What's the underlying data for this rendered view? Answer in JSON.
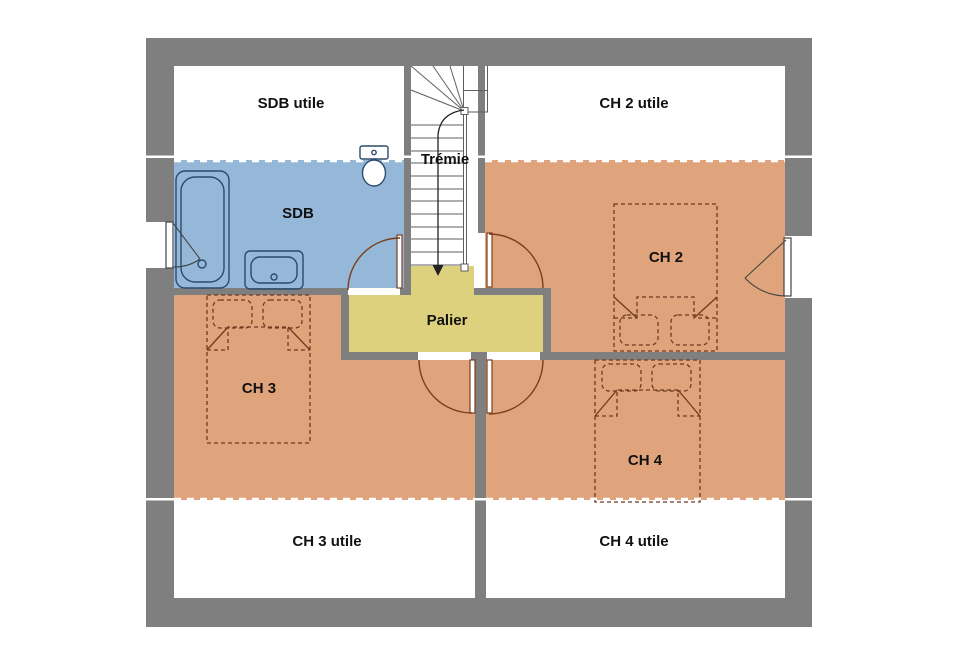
{
  "plan": {
    "labels": {
      "sdb_utile": "SDB utile",
      "ch2_utile": "CH 2 utile",
      "tremie": "Trémie",
      "sdb": "SDB",
      "palier": "Palier",
      "ch2": "CH 2",
      "ch3": "CH 3",
      "ch4": "CH 4",
      "ch3_utile": "CH 3 utile",
      "ch4_utile": "CH 4 utile"
    }
  },
  "colors": {
    "wall": "#7f7f7f",
    "room-bath": "#96b8d8",
    "room-bed": "#e0a47c",
    "room-landing": "#ddd17e",
    "door": "#7b3e1d",
    "furniture": "#6e3b20",
    "fixture": "#2b4a6d",
    "stair-line": "#5f5f5f",
    "text": "#111111"
  }
}
